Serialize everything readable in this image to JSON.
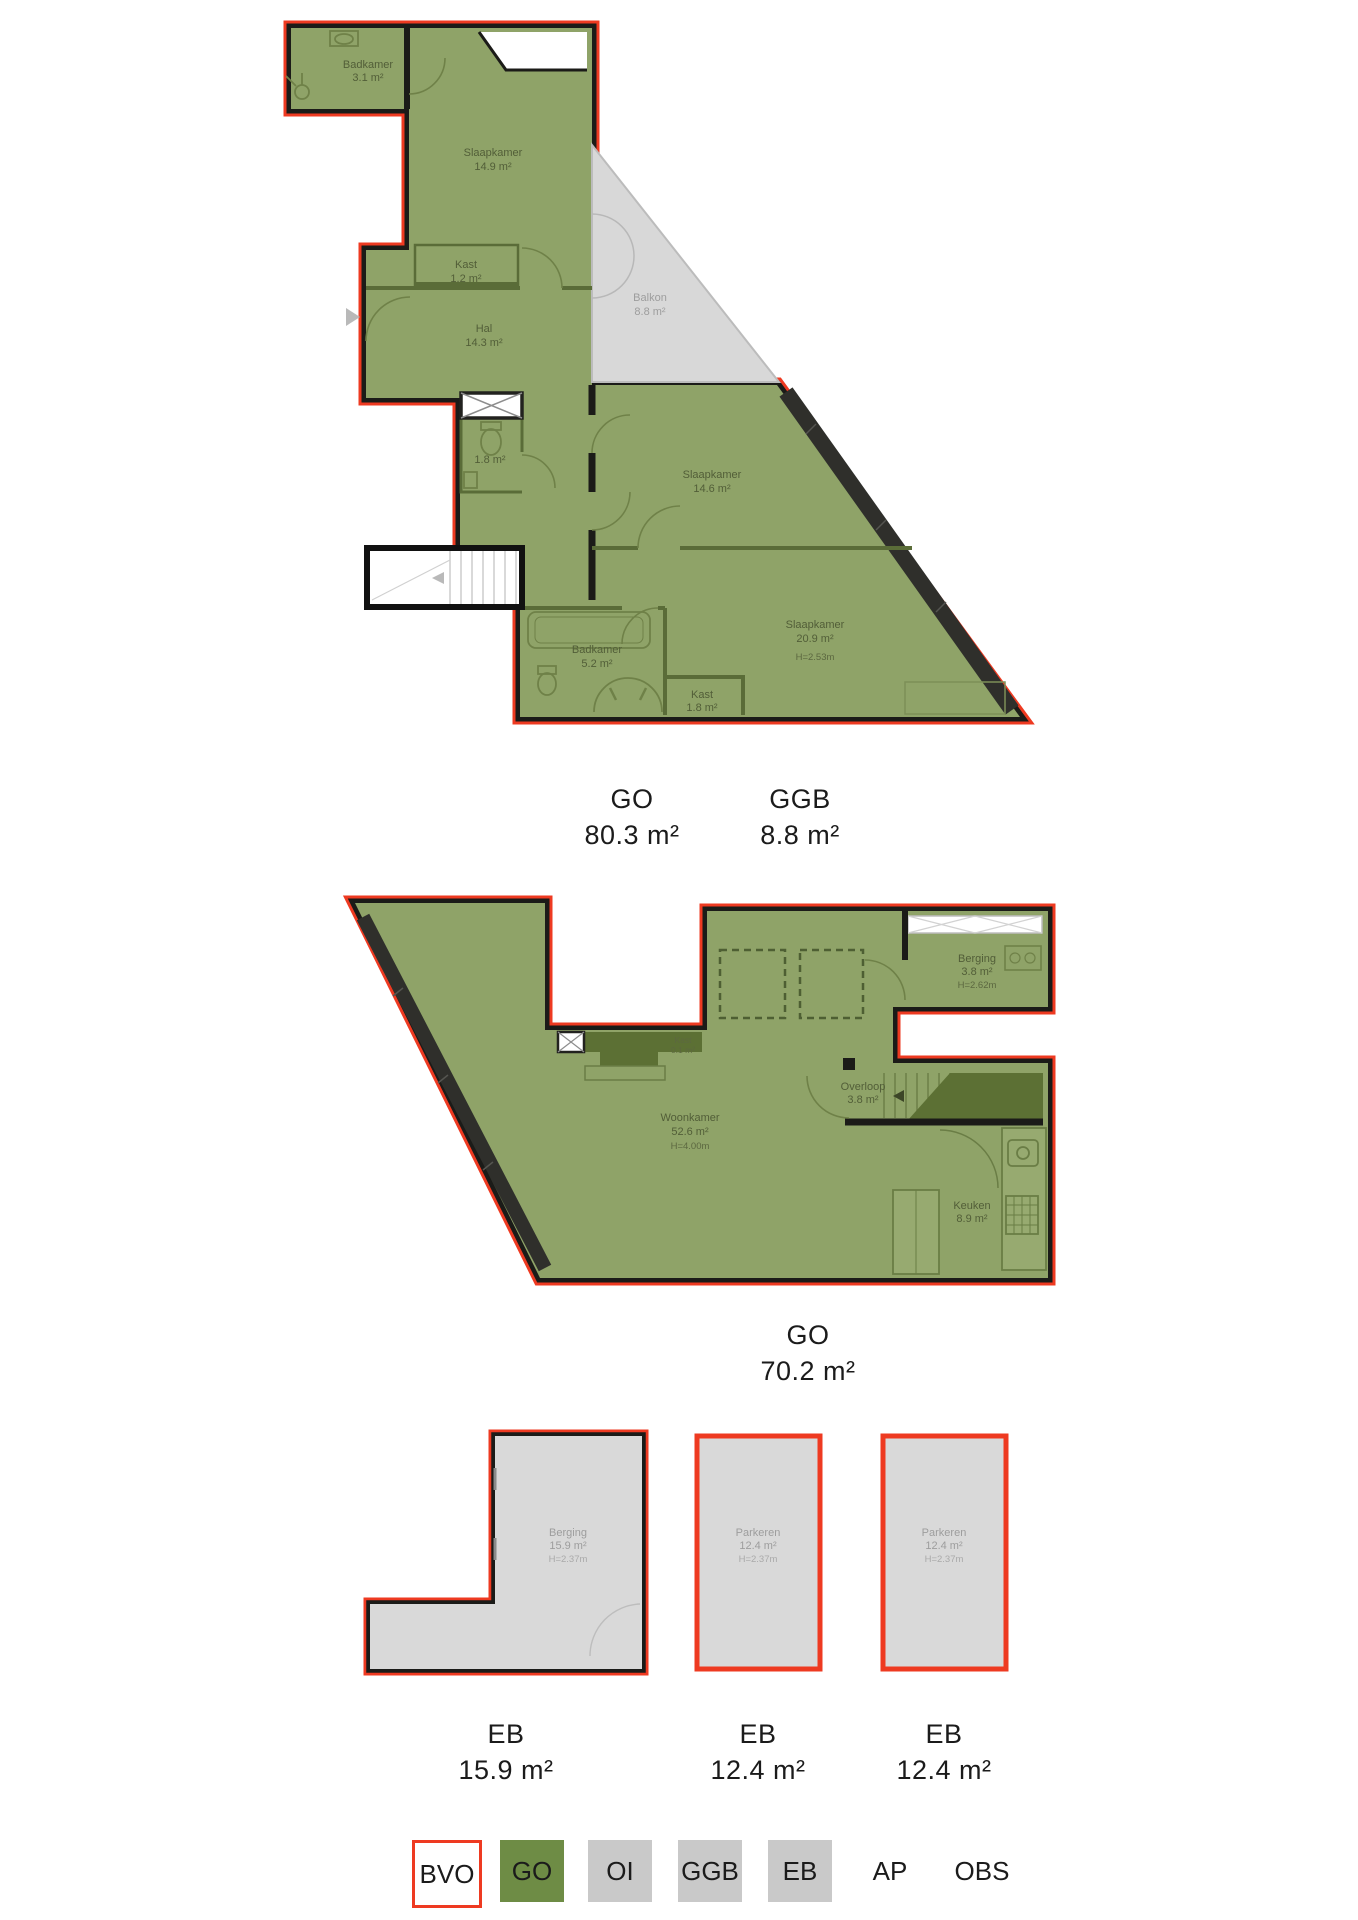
{
  "plans": {
    "plan1": {
      "rooms": {
        "badkamer_top": {
          "name": "Badkamer",
          "area": "3.1 m²"
        },
        "slaapkamer_1": {
          "name": "Slaapkamer",
          "area": "14.9 m²"
        },
        "kast_1": {
          "name": "Kast",
          "area": "1.2 m²"
        },
        "hal": {
          "name": "Hal",
          "area": "14.3 m²"
        },
        "balkon": {
          "name": "Balkon",
          "area": "8.8 m²"
        },
        "toilet": {
          "area": "1.8 m²"
        },
        "slaapkamer_2": {
          "name": "Slaapkamer",
          "area": "14.6 m²"
        },
        "slaapkamer_3": {
          "name": "Slaapkamer",
          "area": "20.9 m²",
          "height": "H=2.53m"
        },
        "badkamer_bottom": {
          "name": "Badkamer",
          "area": "5.2 m²"
        },
        "kast_2": {
          "name": "Kast",
          "area": "1.8 m²"
        }
      },
      "area_labels": [
        {
          "code": "GO",
          "value": "80.3 m²"
        },
        {
          "code": "GGB",
          "value": "8.8 m²"
        }
      ]
    },
    "plan2": {
      "rooms": {
        "berging": {
          "name": "Berging",
          "area": "3.8 m²",
          "height": "H=2.62m"
        },
        "kast_small": {
          "name": "Kast",
          "area": "0.1 m²"
        },
        "overloop": {
          "name": "Overloop",
          "area": "3.8 m²"
        },
        "woonkamer": {
          "name": "Woonkamer",
          "area": "52.6 m²",
          "height": "H=4.00m"
        },
        "keuken": {
          "name": "Keuken",
          "area": "8.9 m²"
        }
      },
      "area_labels": [
        {
          "code": "GO",
          "value": "70.2 m²"
        }
      ]
    },
    "plan3": {
      "units": [
        {
          "name": "Berging",
          "area": "15.9 m²",
          "height": "H=2.37m",
          "label": "EB",
          "label_value": "15.9 m²"
        },
        {
          "name": "Parkeren",
          "area": "12.4 m²",
          "height": "H=2.37m",
          "label": "EB",
          "label_value": "12.4 m²"
        },
        {
          "name": "Parkeren",
          "area": "12.4 m²",
          "height": "H=2.37m",
          "label": "EB",
          "label_value": "12.4 m²"
        }
      ]
    }
  },
  "legend": {
    "items": [
      {
        "label": "BVO"
      },
      {
        "label": "GO"
      },
      {
        "label": "OI"
      },
      {
        "label": "GGB"
      },
      {
        "label": "EB"
      },
      {
        "label": "AP"
      },
      {
        "label": "OBS"
      }
    ]
  },
  "colors": {
    "accent_red": "#ee3a21",
    "go_green": "#6e8c45",
    "room_green": "#8fa368",
    "wall_black": "#1b1b18",
    "grey_fill": "#d9d9d9",
    "legend_grey": "#c9c9c9"
  }
}
